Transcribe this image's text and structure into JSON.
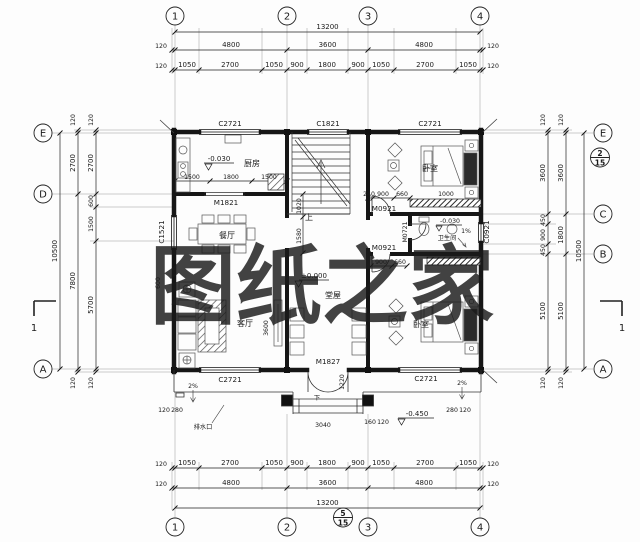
{
  "watermark": {
    "text": "图纸之家",
    "color": "#d93a2b"
  },
  "axes": {
    "top": [
      "1",
      "2",
      "3",
      "4"
    ],
    "bottom": [
      "1",
      "2",
      "3",
      "4"
    ],
    "left": [
      "E",
      "D",
      "A"
    ],
    "right": [
      "E",
      "C",
      "B",
      "A"
    ]
  },
  "bubbles": {
    "right_top": "2",
    "right_bottom": "15",
    "bottom_top": "5",
    "bottom_bottom": "15"
  },
  "sections": {
    "left": "1",
    "right": "1"
  },
  "rooms": {
    "kitchen": "厨房",
    "dining": "餐厅",
    "living": "客厅",
    "hall": "堂屋",
    "bedroom_top": "卧室",
    "bedroom_bottom": "卧室",
    "bath": "卫生间"
  },
  "openings": {
    "win_top_left": "C2721",
    "win_top_mid": "C1821",
    "win_top_right": "C2721",
    "win_left": "C1521",
    "win_right": "C0921",
    "win_bottom_left": "C2721",
    "win_bottom_right": "C2721",
    "door_kitchen": "M1821",
    "door_front": "M1827",
    "door_bed_top": "M0921",
    "door_bed_bottom": "M0921",
    "door_bath": "M0721"
  },
  "levels": {
    "kitchen": "-0.030",
    "hall": "±0.000",
    "bath": "-0.030",
    "terrace": "-0.450"
  },
  "slopes": {
    "bath": "1%",
    "terrace_left": "2%",
    "terrace_right": "2%"
  },
  "stairs": {
    "up": "上",
    "down": "下"
  },
  "notes": {
    "drain": "排水口"
  },
  "dims": {
    "top": {
      "overall": "13200",
      "bays": [
        "4800",
        "3600",
        "4800"
      ],
      "detail": [
        "1050",
        "2700",
        "1050",
        "900",
        "1800",
        "900",
        "1050",
        "2700",
        "1050"
      ],
      "edges": [
        "120",
        "120",
        "120",
        "120"
      ]
    },
    "bottom": {
      "overall": "13200",
      "bays": [
        "4800",
        "3600",
        "4800"
      ],
      "detail": [
        "1050",
        "2700",
        "1050",
        "900",
        "1800",
        "900",
        "1050",
        "2700",
        "1050"
      ],
      "edges": [
        "120",
        "120",
        "120",
        "120"
      ]
    },
    "left": {
      "overall": "10500",
      "outer": [
        "2700",
        "7800"
      ],
      "inner": [
        "2700",
        "600",
        "1500",
        "5700"
      ],
      "edges": [
        "120",
        "120",
        "120",
        "120"
      ]
    },
    "right": {
      "overall": "10500",
      "outer": [
        "3600",
        "1800",
        "5100"
      ],
      "inner": [
        "3600",
        "450",
        "900",
        "450",
        "5100"
      ],
      "edges": [
        "120",
        "120",
        "120",
        "120"
      ]
    },
    "kitchen": [
      "1500",
      "1800",
      "1500"
    ],
    "hall_wall": [
      "1020",
      "1580"
    ],
    "bed_top_wall": [
      "240",
      "900",
      "660"
    ],
    "bed_top_extra": "1000",
    "bath_wall": [
      "900",
      "660"
    ],
    "dining_left": "600",
    "living_height": "3600",
    "porch": {
      "left": [
        "120",
        "280"
      ],
      "center": "3040",
      "right": [
        "280",
        "120"
      ],
      "step_side": [
        "160",
        "120"
      ],
      "depth": "1220"
    }
  }
}
